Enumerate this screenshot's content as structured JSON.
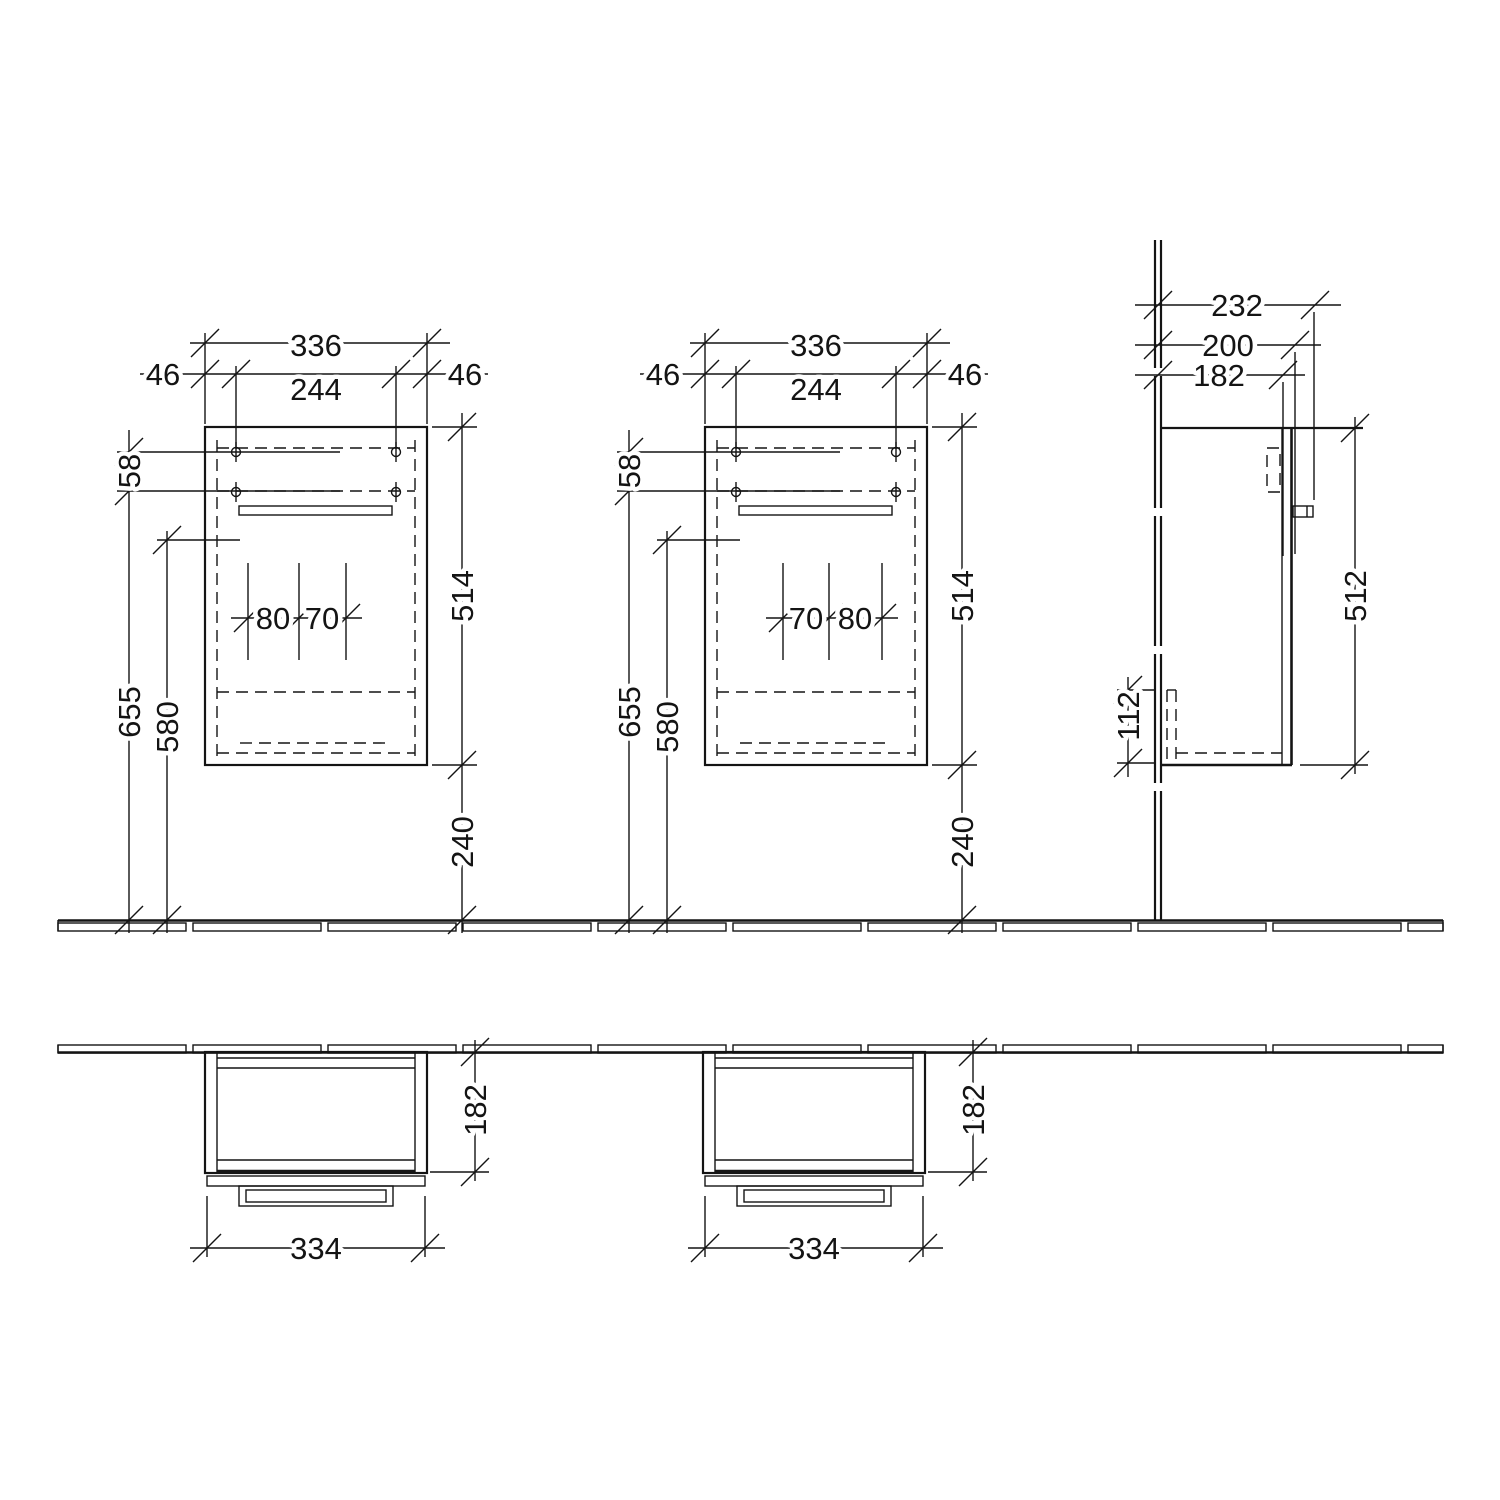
{
  "front_view_1": {
    "overall_width": "336",
    "hole_spacing": "244",
    "left_edge_offset": "46",
    "right_edge_offset": "46",
    "hole_row_gap": "58",
    "height_to_lower_holes": "655",
    "height_to_front_ref": "580",
    "body_height": "514",
    "floor_clearance": "240",
    "cutout_a": "80",
    "cutout_b": "70"
  },
  "front_view_2": {
    "overall_width": "336",
    "hole_spacing": "244",
    "left_edge_offset": "46",
    "right_edge_offset": "46",
    "hole_row_gap": "58",
    "height_to_lower_holes": "655",
    "height_to_front_ref": "580",
    "body_height": "514",
    "floor_clearance": "240",
    "cutout_a": "70",
    "cutout_b": "80"
  },
  "side_view": {
    "depth_incl_handle": "232",
    "depth_incl_door": "200",
    "body_depth": "182",
    "body_height": "512",
    "trap_height": "112"
  },
  "plan_view_1": {
    "body_depth": "182",
    "body_width": "334"
  },
  "plan_view_2": {
    "body_depth": "182",
    "body_width": "334"
  }
}
